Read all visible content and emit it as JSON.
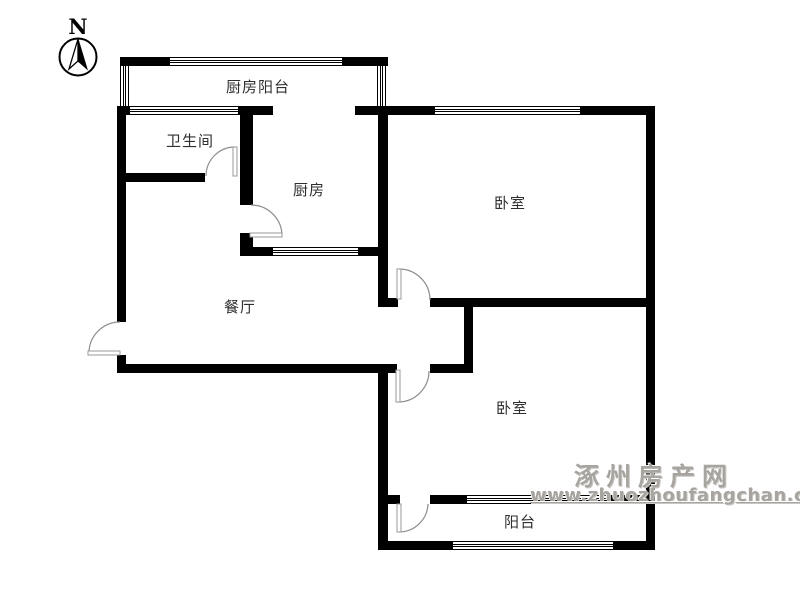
{
  "compass": {
    "north_label": "N"
  },
  "rooms": {
    "kitchen_balcony": {
      "label": "厨房阳台"
    },
    "bathroom": {
      "label": "卫生间"
    },
    "kitchen": {
      "label": "厨房"
    },
    "bedroom_north": {
      "label": "卧室"
    },
    "dining": {
      "label": "餐厅"
    },
    "bedroom_south": {
      "label": "卧室"
    },
    "balcony": {
      "label": "阳台"
    }
  },
  "watermark": {
    "site_name": "涿州房产网",
    "site_url": "www.zhuozhoufangchan.com"
  },
  "colors": {
    "wall": "#000000",
    "door_arc": "#8d8d8d",
    "label_text": "#2f2f2f",
    "watermark": "#a8a5a0"
  }
}
